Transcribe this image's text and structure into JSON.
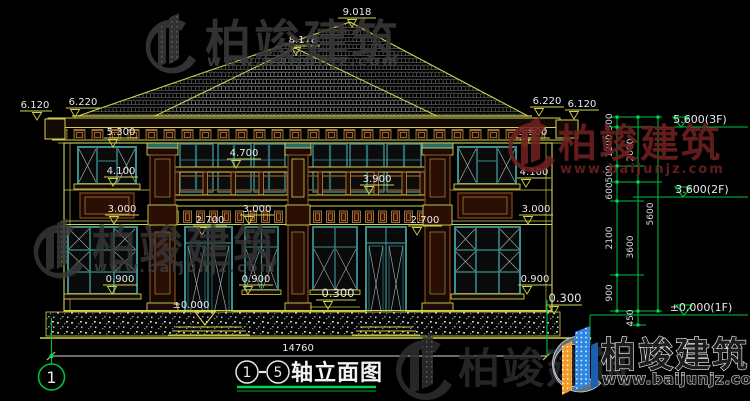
{
  "watermark": {
    "brand": "柏竣建筑",
    "url": "www.baijunjz.com"
  },
  "title": {
    "axis_start": "1",
    "axis_end": "5",
    "name": "轴立面图",
    "axis_bubble": "1"
  },
  "dimensions": {
    "ridge": "9.018",
    "sub_ridge": "8.178",
    "left": [
      "6.120",
      "6.220",
      "5.300",
      "4.100",
      "3.000",
      "0.900"
    ],
    "center": [
      "4.700",
      "3.900",
      "3.000",
      "2.700",
      "2.700",
      "0.900",
      "0.300",
      "±0.000"
    ],
    "right": [
      "6.220",
      "6.120",
      "5.300",
      "4.100",
      "3.000",
      "0.900",
      "0.300"
    ],
    "total_width": "14760",
    "chain_inner": [
      "300",
      "1200",
      "500",
      "600",
      "2100",
      "900"
    ],
    "chain_middle": [
      "2000",
      "3600",
      "450"
    ],
    "chain_outer": [
      "5600"
    ],
    "levels": [
      "5.600(3F)",
      "3.600(2F)",
      "±0.000(1F)"
    ]
  },
  "colors": {
    "cad_yellow": "#d2d24f",
    "cad_green": "#00c040",
    "teal": "#3b8f8f",
    "brown": "#8a4a1e",
    "text_white": "#e9e9e9",
    "watermark_gray": "#3a3a3a",
    "watermark_red": "#702020",
    "logo_blue": "#2e86e0",
    "logo_orange": "#f09a28"
  }
}
